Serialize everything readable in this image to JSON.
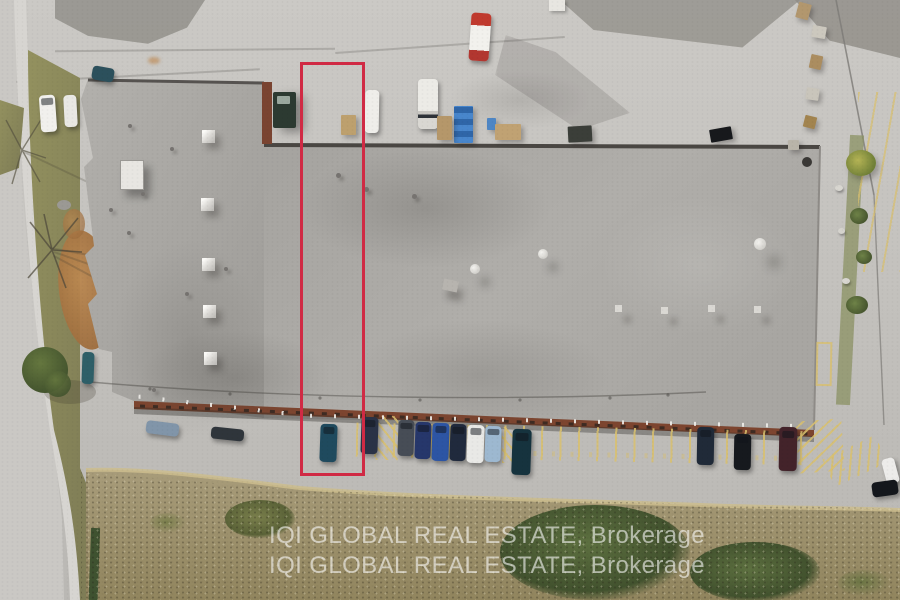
{
  "watermark": {
    "line1": "IQI GLOBAL REAL ESTATE, Brokerage",
    "line2": "IQI GLOBAL REAL ESTATE, Brokerage"
  },
  "highlight": {
    "color": "#d02a44"
  },
  "palette": {
    "pavement": "#c6c4c0",
    "pavement_light": "#d0cec9",
    "pavement_dark": "#95938e",
    "road": "#cac8c4",
    "sidewalk": "#d7d5d1",
    "grass": "#8a8862",
    "brush": "#a29674",
    "brush_dark": "#8c8158",
    "foliage": "#57693c",
    "foliage_dark": "#3f502c",
    "leaf_litter": "#b07a44",
    "roof": "#a9a7a3",
    "roof_light": "#b6b4b0",
    "roof_dark": "#908e8a",
    "parapet": "#4c4945",
    "facade": "#7d452f",
    "stall_line": "#d9c06e",
    "hedge": "#5d7040",
    "watermark_text": "rgba(255,255,255,0.58)"
  },
  "vehicles": {
    "car_teal_in_unit": "#1f4a5e",
    "car_navy_a": "#2a3246",
    "car_gray": "#474d56",
    "car_blue_dark": "#26376b",
    "car_blue": "#2d55a4",
    "car_navy_b": "#202a3d",
    "car_white": "#e9e9e6",
    "car_light_blue": "#9db8d0",
    "car_teal_long": "#16333e",
    "car_dark_right": "#202a38",
    "suv_black": "#16191e",
    "pickup_dark_red": "#43232a",
    "car_white_corner": "#edecea",
    "car_black_corner": "#14171c",
    "car_front_silver_blue": "#8195a9",
    "car_front_dark": "#2f353b",
    "car_white_left": "#f1f0ed",
    "van_white_left": "#e9e8e4",
    "car_teal_top": "#2c505c",
    "car_teal_nook": "#2e5f68",
    "van_dock_white": "#efeeea",
    "tarp_blue": "#3f7cc2",
    "tarp_blue_small": "#4e86c4",
    "pallet_tan": "#b5976a",
    "pallet_tan2": "#c0a273",
    "pallet_tan3": "#bda06e",
    "stack_dark": "#3b3e39",
    "panel_black": "#17191c",
    "dumpster_green": "#2c3a31"
  }
}
